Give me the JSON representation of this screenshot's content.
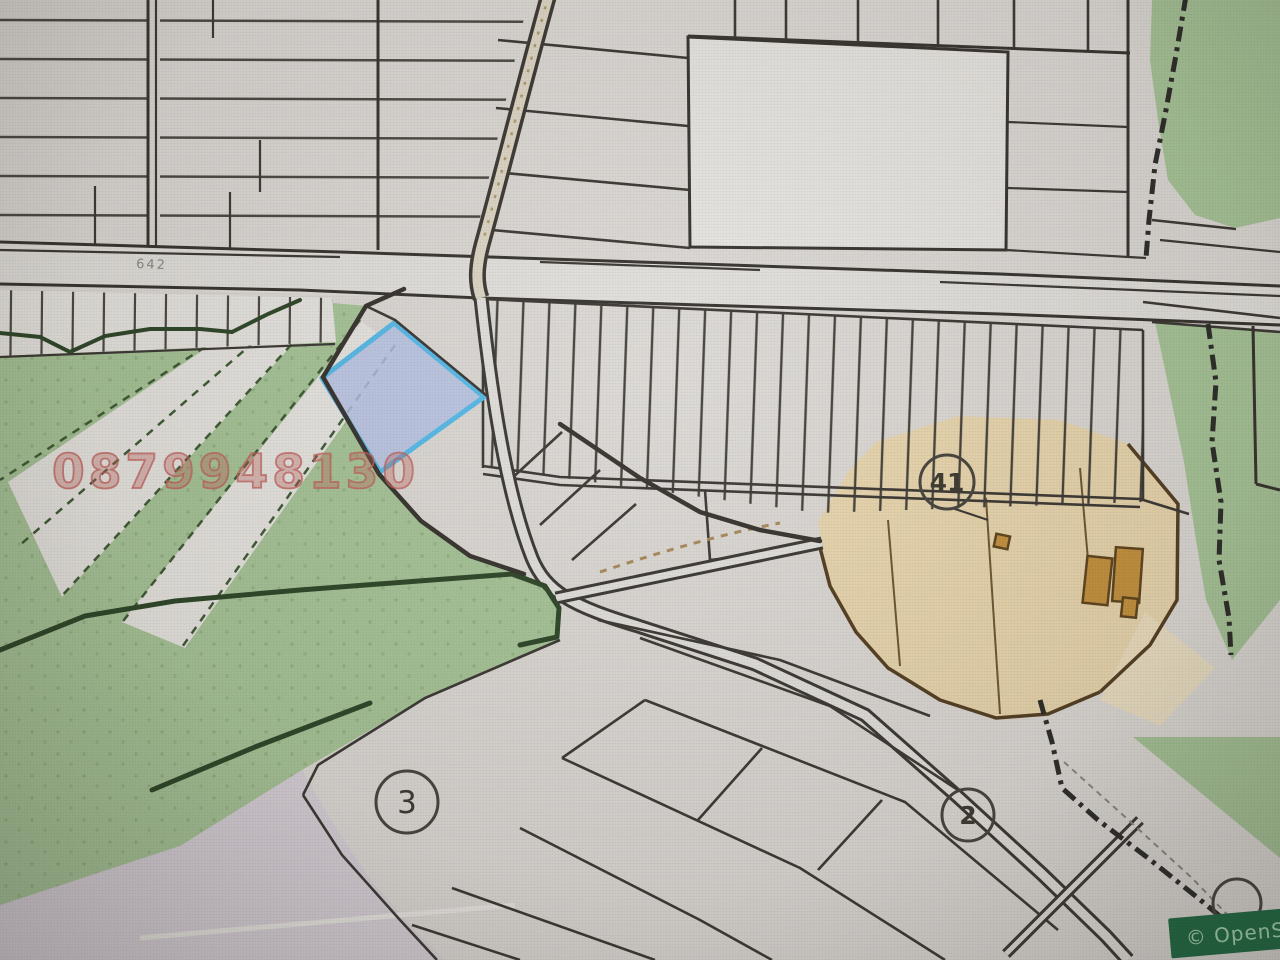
{
  "colors": {
    "bg": "#dcd9d5",
    "bg_light": "#e7e5e1",
    "road_fill": "#e2e0dc",
    "green": "#a6c497",
    "tan": "#e8d6ad",
    "tan_light": "#ecdfc0",
    "lavender": "#d6cfd8",
    "blue_fill": "#b5c2e4",
    "blue_stroke": "#55bae9",
    "building_fill": "#c4913c",
    "building_stroke": "#5e431c",
    "watermark": "#c05e58",
    "banner_bg": "#1e6a43",
    "banner_text": "#a5d6b2",
    "label_gray": "#8d8a84"
  },
  "map": {
    "watermark_phone": "0879948130",
    "road_label": "642",
    "markers": [
      {
        "label": "41"
      },
      {
        "label": "3"
      },
      {
        "label": "2"
      }
    ],
    "attribution": "© OpenSt"
  }
}
